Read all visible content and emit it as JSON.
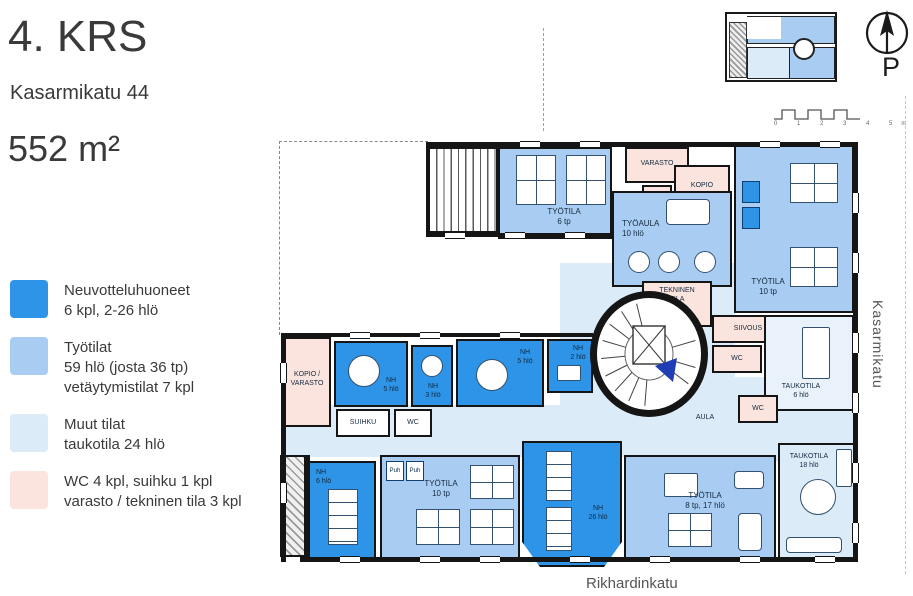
{
  "header": {
    "floor": "4. KRS",
    "address": "Kasarmikatu 44",
    "area": "552 m²"
  },
  "palette": {
    "meeting": "#2e94e7",
    "work": "#a9cdf2",
    "other": "#dcebf8",
    "other_light": "#e9f2fb",
    "service": "#fbe4de",
    "wall": "#151515",
    "accent_arrow": "#1f3db5"
  },
  "legend": {
    "items": [
      {
        "color": "#2e94e7",
        "text": "Neuvotteluhuoneet\n6 kpl, 2-26 hlö"
      },
      {
        "color": "#a9cdf2",
        "text": "Työtilat\n59 hlö (josta 36 tp)\nvetäytymistilat 7 kpl"
      },
      {
        "color": "#dcebf8",
        "text": "Muut tilat\ntaukotila 24 hlö"
      },
      {
        "color": "#fbe4de",
        "text": "WC 4 kpl, suihku 1 kpl\nvarasto / tekninen tila 3 kpl"
      }
    ]
  },
  "compass": {
    "north_label": "P"
  },
  "scalebar": {
    "label": "0 1 2 3 4 5m"
  },
  "streets": {
    "right": "Kasarmikatu",
    "bottom": "Rikhardinkatu"
  },
  "rooms": {
    "tyotila_6tp": "TYÖTILA\n6 tp",
    "varasto": "VARASTO",
    "wc": "WC",
    "kopio": "KOPIO",
    "tyoaula": "TYÖAULA\n10 hlö",
    "tekninen": "TEKNINEN\nTILA",
    "tyotila_10tp": "TYÖTILA\n10 tp",
    "siivous": "SIIVOUS",
    "taukotila_6": "TAUKOTILA\n6 hlö",
    "aula": "AULA",
    "kopio_varasto": "KOPIO /\nVARASTO",
    "nh5": "NH\n5 hlö",
    "nh3": "NH\n3 hlö",
    "nh2": "NH\n2 hlö",
    "suihku": "SUIHKU",
    "nh6": "NH\n6 hlö",
    "puh": "Puh",
    "nh26": "NH\n26 hlö",
    "tyotila_8tp": "TYÖTILA\n8 tp, 17 hlö",
    "taukotila_18": "TAUKOTILA\n18 hlö"
  }
}
